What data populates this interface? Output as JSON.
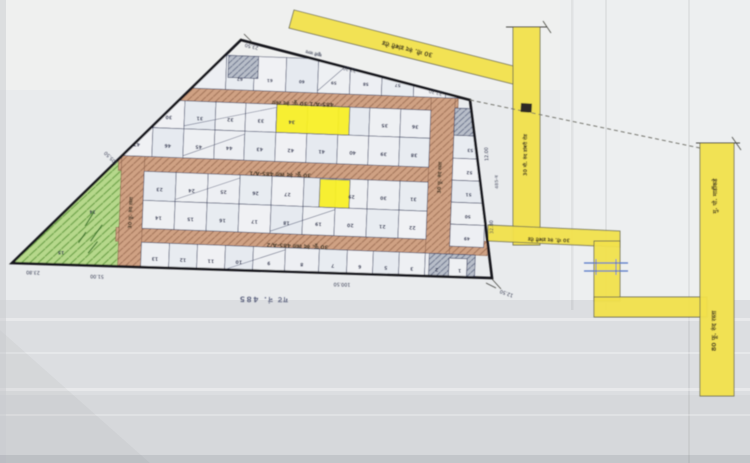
{
  "document": {
    "type": "scanned-land-survey-layout-plan",
    "caption": "गट नं. 485",
    "apex_note": "खुली जागा",
    "neighbour_note": "485-ब"
  },
  "colors": {
    "paper": "#e9ebed",
    "paper_top": "#eff0ef",
    "paper_bottom": "#dcdee1",
    "paper_deep": "#d6d8db",
    "boundary": "#17171c",
    "grid_line": "#3a4163",
    "number_ink": "#262c4e",
    "measure_ink": "#34394f",
    "label_ink": "#3b3322",
    "road_brown": "#cfa183",
    "road_brown_hatch": "#a3755a",
    "road_yellow": "#f2e14c",
    "road_yellow_edge": "#6e6e52",
    "plot_yellow": "#f8ef25",
    "green_fill": "#b6d88b",
    "green_hatch": "#6da348",
    "grey_fill": "#b8bec9",
    "grey_hatch": "#6d768e",
    "blue_mark": "#5574c8",
    "cell_fills": [
      "#edeff3",
      "#e8ecf1",
      "#f0f1f4",
      "#e6eaf0",
      "#eef0f3"
    ]
  },
  "map": {
    "boundary": [
      [
        241,
        40
      ],
      [
        470,
        100
      ],
      [
        492,
        278
      ],
      [
        12,
        263
      ]
    ],
    "inner_rotation": {
      "angle": 2.2,
      "cx": 240,
      "cy": 180
    },
    "rows": [
      {
        "name": "top-plot-row",
        "y": [
          56,
          90
        ],
        "numY": 78,
        "div": [
          188,
          222,
          250,
          282,
          314,
          346,
          378,
          410,
          442,
          466
        ],
        "nums": [
          "",
          "62",
          "61",
          "60",
          "59",
          "58",
          "57",
          "56",
          "55"
        ]
      },
      {
        "name": "block-a-top-row",
        "y": [
          103,
          131
        ],
        "div": [
          120,
          151,
          182,
          213,
          243,
          274,
          305,
          336,
          367,
          398,
          428
        ],
        "nums": [
          "29",
          "30",
          "31",
          "32",
          "33",
          "34",
          "",
          "",
          "35",
          "36"
        ]
      },
      {
        "name": "block-a-bottom-row",
        "y": [
          131,
          160
        ],
        "div": [
          120,
          151,
          182,
          213,
          243,
          274,
          305,
          336,
          367,
          398,
          428
        ],
        "nums": [
          "47",
          "46",
          "45",
          "44",
          "43",
          "42",
          "41",
          "40",
          "39",
          "38"
        ]
      },
      {
        "name": "block-b-top-row",
        "y": [
          175,
          204
        ],
        "div": [
          144,
          176,
          208,
          240,
          272,
          304,
          336,
          368,
          400,
          428
        ],
        "nums": [
          "23",
          "24",
          "25",
          "26",
          "27",
          "",
          "29",
          "30",
          "31"
        ]
      },
      {
        "name": "block-b-bottom-row",
        "y": [
          204,
          232
        ],
        "div": [
          144,
          176,
          208,
          240,
          272,
          304,
          336,
          368,
          400,
          428
        ],
        "nums": [
          "14",
          "15",
          "16",
          "17",
          "18",
          "19",
          "20",
          "21",
          "22"
        ]
      },
      {
        "name": "bottom-plot-row",
        "y": [
          246,
          272
        ],
        "div": [
          144,
          172,
          200,
          228,
          256,
          288,
          322,
          350,
          376,
          402,
          428,
          452,
          474
        ],
        "nums": [
          "13",
          "12",
          "11",
          "10",
          "9",
          "8",
          "7",
          "6",
          "5",
          "3",
          "2",
          "1"
        ]
      }
    ],
    "right_column": {
      "x": [
        452,
        486
      ],
      "rows": [
        [
          100,
          127
        ],
        [
          127,
          150
        ],
        [
          150,
          172
        ],
        [
          172,
          194
        ],
        [
          194,
          216
        ],
        [
          216,
          238
        ]
      ],
      "nums": [
        "54",
        "53",
        "52",
        "51",
        "50",
        "49"
      ]
    },
    "internal_roads": [
      {
        "name": "internal-road-485a1-upper",
        "rect": [
          118,
          90,
          337,
          13
        ]
      },
      {
        "name": "internal-road-485a1-lower",
        "rect": [
          118,
          160,
          337,
          15
        ]
      },
      {
        "name": "internal-road-485a2",
        "rect": [
          118,
          232,
          372,
          14
        ]
      },
      {
        "name": "internal-road-left-vertical",
        "rect": [
          121,
          160,
          23,
          115
        ]
      },
      {
        "name": "internal-road-right-vertical",
        "rect": [
          428,
          90,
          24,
          156
        ]
      }
    ],
    "local_labels": [
      {
        "t": "485-A/1   30 फू. रुंद रस्ता",
        "x": 300,
        "y": 99.5,
        "rot": 180,
        "s": 5.6
      },
      {
        "t": "30 फू. रुंद रस्ता   485-A/1",
        "x": 280,
        "y": 171,
        "rot": 180,
        "s": 5.6
      },
      {
        "t": "30 फू. रुंद रस्ता   485-A/2",
        "x": 300,
        "y": 242,
        "rot": 180,
        "s": 5.6
      },
      {
        "t": "30 फू. रुंद रस्ता",
        "x": 133.5,
        "y": 217,
        "rot": 270,
        "s": 5.0
      },
      {
        "t": "30 फू. रुंद रस्ता",
        "x": 441,
        "y": 170,
        "rot": 270,
        "s": 5.0
      }
    ],
    "yellow_plots": [
      {
        "name": "highlighted-plot-34",
        "rect": [
          274,
          103,
          73,
          28
        ]
      },
      {
        "name": "highlighted-plot-29",
        "rect": [
          320,
          176,
          30,
          28
        ]
      }
    ],
    "hatched_areas": [
      {
        "name": "hatched-apex-cell",
        "rect": [
          224,
          56,
          30,
          22
        ]
      },
      {
        "name": "hatched-right-column-top-cell",
        "rect": [
          452,
          100,
          34,
          27
        ]
      },
      {
        "name": "hatched-bottom-corner-cells",
        "rect": [
          432,
          246,
          46,
          26
        ]
      }
    ],
    "white_cells": [
      [
        452,
        250,
        18,
        18
      ]
    ],
    "slashes": [
      [
        182,
        128,
        274,
        106
      ],
      [
        182,
        158,
        243,
        134
      ],
      [
        176,
        202,
        240,
        178
      ],
      [
        272,
        230,
        336,
        206
      ],
      [
        228,
        270,
        288,
        248
      ],
      [
        314,
        88,
        346,
        58
      ]
    ],
    "green_area": {
      "name": "green-open-space",
      "rect": [
        0,
        140,
        121,
        135
      ],
      "numbers": [
        {
          "t": "14",
          "x": 94,
          "y": 216
        },
        {
          "t": "15",
          "x": 64,
          "y": 258
        }
      ]
    },
    "yellow_roads": [
      {
        "name": "yellow-road-diagonal",
        "poly": [
          [
            294,
            10
          ],
          [
            513,
            66
          ],
          [
            513,
            84
          ],
          [
            289,
            28
          ]
        ]
      },
      {
        "name": "yellow-road-vertical-1",
        "poly": [
          [
            513,
            27
          ],
          [
            540,
            27
          ],
          [
            540,
            245
          ],
          [
            513,
            245
          ]
        ]
      },
      {
        "name": "yellow-road-horizontal",
        "poly": [
          [
            488,
            225
          ],
          [
            620,
            231
          ],
          [
            620,
            247
          ],
          [
            488,
            241
          ]
        ]
      },
      {
        "name": "yellow-road-elbow-vertical",
        "poly": [
          [
            594,
            241
          ],
          [
            620,
            241
          ],
          [
            620,
            301
          ],
          [
            594,
            301
          ]
        ]
      },
      {
        "name": "yellow-road-elbow-horizontal",
        "poly": [
          [
            594,
            297
          ],
          [
            707,
            297
          ],
          [
            707,
            317
          ],
          [
            594,
            317
          ]
        ]
      },
      {
        "name": "yellow-road-right-highway",
        "poly": [
          [
            700,
            143
          ],
          [
            734,
            143
          ],
          [
            734,
            396
          ],
          [
            700,
            396
          ]
        ]
      }
    ],
    "global_labels": [
      {
        "t": "30 मी. रुंद डांबरी रोड",
        "x": 408,
        "y": 47,
        "rot": 194,
        "s": 6.2,
        "c": "#3b3322"
      },
      {
        "t": "30 मी. रुंद डांबरी रोड",
        "x": 527,
        "y": 155,
        "rot": 270,
        "s": 5.0,
        "c": "#3b3322"
      },
      {
        "t": "30 मी. रुंद डांबरी रोड",
        "x": 549,
        "y": 238,
        "rot": 182,
        "s": 5.0,
        "c": "#3b3322"
      },
      {
        "t": "मु. पो. मार्डीकडे",
        "x": 717,
        "y": 196,
        "rot": 270,
        "s": 6.0,
        "c": "#3b3322"
      },
      {
        "t": "80 फू. रुंद रस्ता",
        "x": 716,
        "y": 331,
        "rot": 270,
        "s": 6.4,
        "c": "#3b3322"
      },
      {
        "t": "खुली जागा",
        "x": 314,
        "y": 52,
        "rot": 194,
        "s": 4.2,
        "c": "#34394f",
        "op": 0.8
      },
      {
        "t": "485-ब",
        "x": 498,
        "y": 182,
        "rot": 268,
        "s": 4.4,
        "c": "#34394f",
        "op": 0.55
      },
      {
        "t": "गट नं. 485",
        "x": 263,
        "y": 297,
        "rot": 181,
        "s": 7.5,
        "c": "#3a4163",
        "op": 0.75,
        "ls": 1.5
      }
    ],
    "measurements": [
      {
        "t": "23.50",
        "x": 252,
        "y": 45,
        "rot": 194
      },
      {
        "t": "32.30",
        "x": 350,
        "y": 68,
        "rot": 194
      },
      {
        "t": "32.30",
        "x": 436,
        "y": 91,
        "rot": 194
      },
      {
        "t": "12.00",
        "x": 488,
        "y": 154,
        "rot": 268
      },
      {
        "t": "32.80",
        "x": 493,
        "y": 227,
        "rot": 268
      },
      {
        "t": "12.50",
        "x": 507,
        "y": 292,
        "rot": 200
      },
      {
        "t": "100.50",
        "x": 342,
        "y": 283,
        "rot": 182
      },
      {
        "t": "51.00",
        "x": 97,
        "y": 275,
        "rot": 182
      },
      {
        "t": "23.80",
        "x": 33,
        "y": 271,
        "rot": 182
      },
      {
        "t": "105.50",
        "x": 112,
        "y": 157,
        "rot": 224
      }
    ],
    "lines": [
      {
        "x1": 470,
        "y1": 100,
        "x2": 700,
        "y2": 148,
        "w": 0.9,
        "c": "#6a6a62",
        "dash": "4 3",
        "name": "boundary-extension-line"
      },
      {
        "x1": 506,
        "y1": 27,
        "x2": 547,
        "y2": 27,
        "w": 1,
        "c": "#4a4a44",
        "name": "survey-tick"
      },
      {
        "x1": 543,
        "y1": 21,
        "x2": 551,
        "y2": 33,
        "w": 0.8,
        "c": "#4a4a44",
        "name": "survey-tick"
      },
      {
        "x1": 696,
        "y1": 143,
        "x2": 740,
        "y2": 143,
        "w": 1,
        "c": "#4a4a44",
        "name": "survey-tick"
      },
      {
        "x1": 732,
        "y1": 137,
        "x2": 741,
        "y2": 150,
        "w": 0.8,
        "c": "#4a4a44",
        "name": "survey-tick"
      },
      {
        "x1": 584,
        "y1": 263,
        "x2": 628,
        "y2": 263,
        "w": 1.3,
        "c": "#5574c8",
        "name": "culvert-icon"
      },
      {
        "x1": 584,
        "y1": 271,
        "x2": 628,
        "y2": 271,
        "w": 1.3,
        "c": "#5574c8",
        "name": "culvert-icon"
      },
      {
        "x1": 596,
        "y1": 259,
        "x2": 596,
        "y2": 275,
        "w": 1,
        "c": "#5574c8",
        "name": "culvert-icon"
      },
      {
        "x1": 616,
        "y1": 259,
        "x2": 616,
        "y2": 275,
        "w": 1,
        "c": "#5574c8",
        "name": "culvert-icon"
      },
      {
        "x1": 492,
        "y1": 279,
        "x2": 501,
        "y2": 289,
        "w": 0.8,
        "c": "#4a4a44",
        "name": "survey-tick"
      },
      {
        "x1": 486,
        "y1": 283,
        "x2": 496,
        "y2": 288,
        "w": 0.8,
        "c": "#4a4a44",
        "name": "survey-tick"
      },
      {
        "x1": 244,
        "y1": 34,
        "x2": 252,
        "y2": 42,
        "w": 0.8,
        "c": "#4a4a44",
        "name": "survey-tick"
      }
    ],
    "marks": [
      {
        "name": "road-blot-mark",
        "rect": [
          521,
          103,
          11,
          9
        ],
        "fill": "#2e2b28",
        "rot": 3
      }
    ]
  }
}
